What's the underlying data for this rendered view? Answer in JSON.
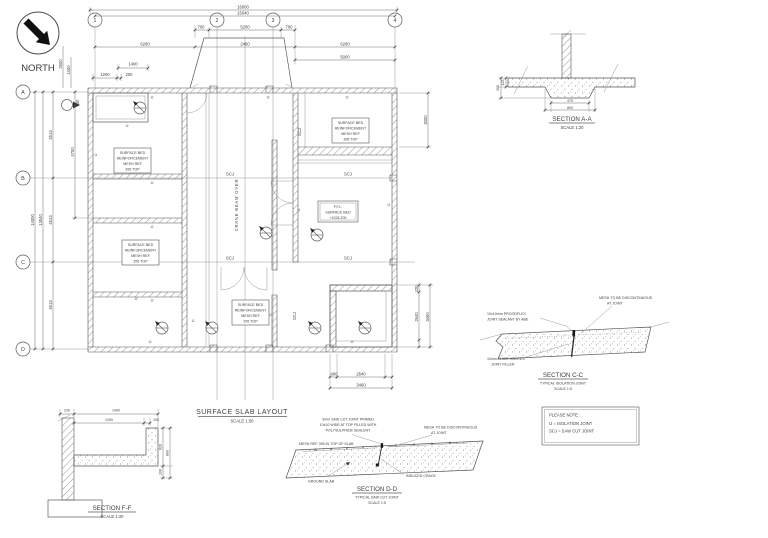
{
  "north": {
    "label": "NORTH"
  },
  "plan": {
    "title": "SURFACE SLAB LAYOUT",
    "scale": "SCALE 1:50",
    "grid_cols": [
      "1",
      "2",
      "3",
      "4"
    ],
    "grid_rows": [
      "A",
      "B",
      "C",
      "D"
    ],
    "dims": {
      "overall_width": "16000",
      "grid_width": "15040",
      "ramp_side": "700",
      "ramp_mid": "5200",
      "bay_side": "6290",
      "bay_mid": "2460",
      "right_5000": "5000",
      "plat_1400": "1400",
      "plat_1200": "1200",
      "plat_200": "200",
      "plat_400": "400",
      "overall_height": "14000",
      "grid_height": "13040",
      "row": "4513",
      "left_4700": "4700",
      "tl_2500": "2500",
      "tl_1400": "1400",
      "right_3000": "3000",
      "pit_420": "420",
      "pit_2640": "2640",
      "pit_3460": "3460",
      "pit_400": "400"
    },
    "labels": {
      "crane": "CRANE BEAM OVER",
      "scj": "SCJ",
      "ij": "IJ"
    },
    "mesh_box": {
      "l1": "SURFACE BED",
      "l2": "REINFORCEMENT",
      "l3": "MESH REF",
      "l4": "395 TOP"
    },
    "ffl_box": {
      "l1": "F.F.L.",
      "l2": "SURFACE BED",
      "l3": "+1028.200"
    }
  },
  "sections": {
    "aa": {
      "title": "SECTION A-A",
      "scale": "SCALE 1:20",
      "dims": {
        "d125": "125",
        "d300": "300",
        "d470": "470",
        "d800": "800"
      }
    },
    "cc": {
      "title": "SECTION C-C",
      "subtitle": "TYPICAL ISOLATION JOINT",
      "scale": "SCALE 1:5",
      "sealant_note": [
        "10x10mm PROODFLEX",
        "JOINT SEALANT BY ABE"
      ],
      "mesh_note": [
        "MESH TO BE DISCONTINUOUS",
        "AT JOINT"
      ],
      "filler_note": [
        "10mm THICK JOINTEX",
        "JOINT FILLER"
      ]
    },
    "dd": {
      "title": "SECTION D-D",
      "subtitle": "TYPICAL SAW CUT JOINT",
      "scale": "SCALE 1:5",
      "cut_note": [
        "3mm SAW CUT JOINT PRIMED",
        "10x10 WIDE AT TOP FILLED WITH",
        "POLYSULPHIDE SEALENT"
      ],
      "mesh_note": "MESH REF 395 IN TOP OF SLAB",
      "disc_note": [
        "MESH TO BE DISCONTINUOUS",
        "AT JOINT"
      ],
      "ground_note": "GROUND SLAB",
      "crack_note": "INDUCED CRACK"
    },
    "ff": {
      "title": "SECTION F-F",
      "scale": "SCALE 1:20",
      "dims": {
        "d230": "230",
        "d1400": "1400",
        "d1200": "1200",
        "d100": "100",
        "d620": "620",
        "d800": "800",
        "d200": "200"
      }
    }
  },
  "note_box": {
    "line1": "PLEASE NOTE :",
    "line2": "IJ = ISOLATION JOINT",
    "line3": "SCJ = SAW CUT JOINT"
  }
}
